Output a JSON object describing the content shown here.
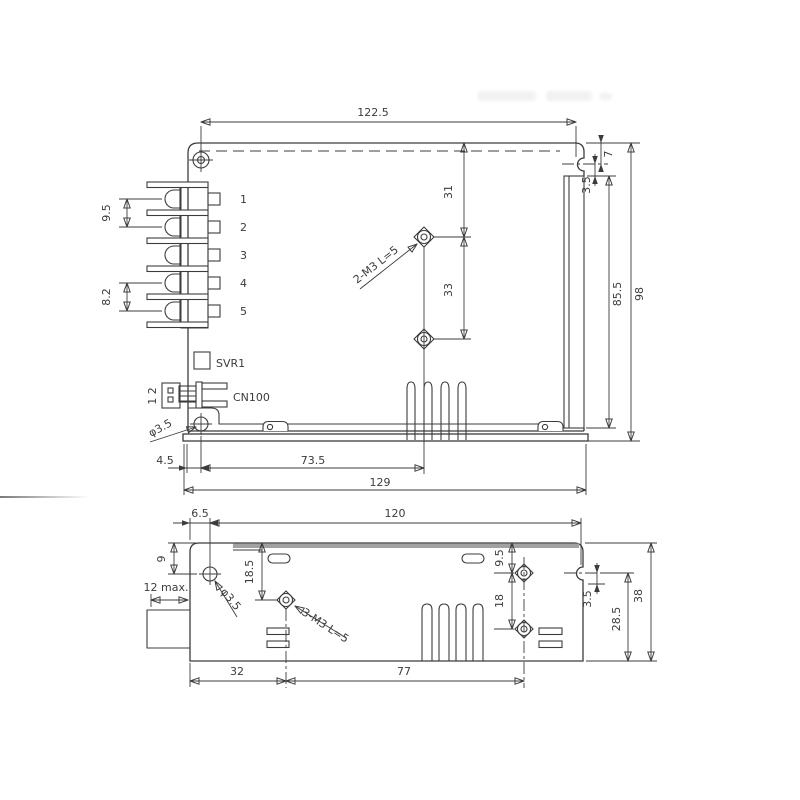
{
  "colors": {
    "line": "#3c3c3c",
    "cover_strip": "#a2a2a2",
    "background": "#ffffff"
  },
  "top_view": {
    "terminals": [
      "1",
      "2",
      "3",
      "4",
      "5"
    ],
    "labels": {
      "svr1": "SVR1",
      "cn100": "CN100",
      "connector_pins": "1 2",
      "hole_dia": "φ3.5",
      "mount_thread": "2-M3 L=5"
    },
    "dims": {
      "overall_width": "122.5",
      "base_width": "129",
      "hole_offset": "4.5",
      "hole_to_mount_center": "73.5",
      "terminal_pitch_top": "9.5",
      "terminal_pitch_bottom": "8.2",
      "mount_hole_top_offset": "31",
      "mount_hole_pitch": "33",
      "slot_top_offset": "7",
      "slot_drop": "3.5",
      "rail_length": "85.5",
      "overall_height": "98"
    }
  },
  "bottom_view": {
    "labels": {
      "hole_dia": "φ3.5",
      "mount_thread": "3-M3 L=5",
      "protrusion_max": "12 max."
    },
    "dims": {
      "edge_to_hole": "6.5",
      "mount_width": "120",
      "hole_top_offset": "9",
      "hole_to_thread": "18.5",
      "left_to_thread": "32",
      "thread_span": "77",
      "thread_top_offset": "9.5",
      "thread_pitch": "18",
      "slot_drop": "3.5",
      "slot_to_bottom": "28.5",
      "overall_depth": "38"
    }
  }
}
